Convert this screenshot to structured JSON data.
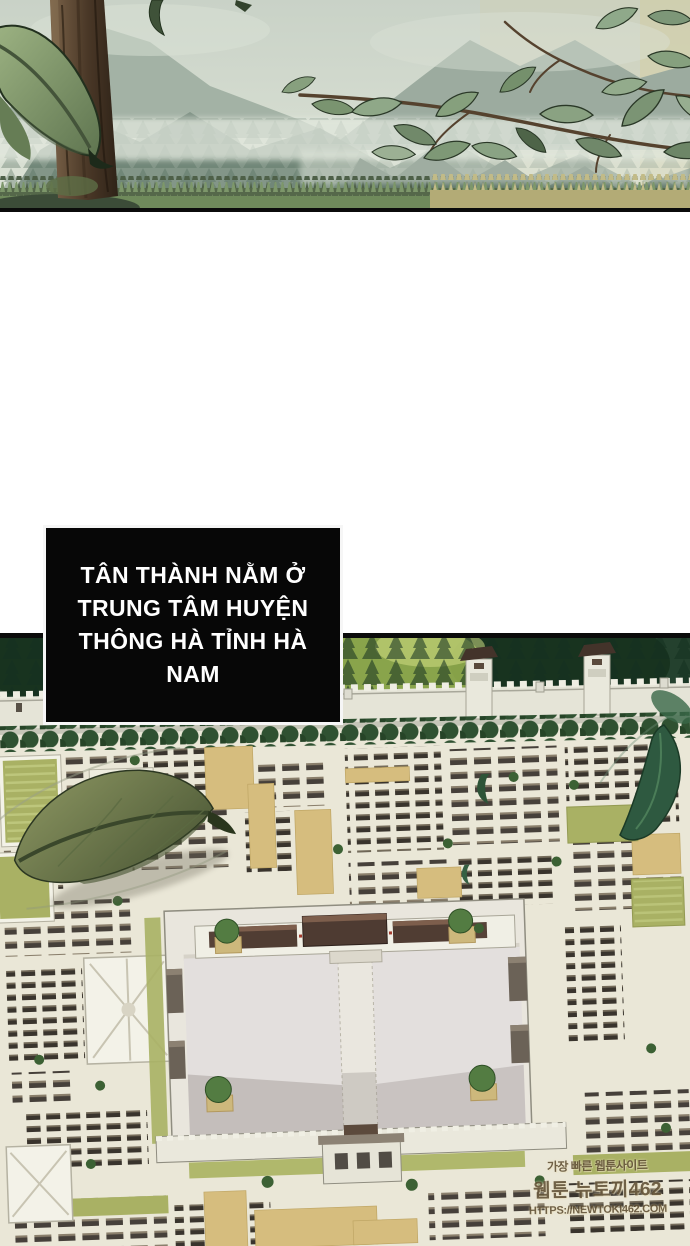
{
  "caption": {
    "lines": [
      "TÂN THÀNH NẰM Ở",
      "TRUNG TÂM HUYỆN",
      "THÔNG HÀ TỈNH HÀ",
      "NAM"
    ]
  },
  "watermark": {
    "line1": "가장 빠른 웹툰사이트",
    "line2": "웹툰 뉴토끼462",
    "line3": "HTTPS://NEWTOKI462.COM"
  },
  "panels": {
    "nature": {
      "alt": "Misty mountain valley with pine forest, tree trunk, grass and falling leaves"
    },
    "city": {
      "alt": "Aerial isometric view of an ancient walled city with a large central palace courtyard"
    }
  },
  "colors": {
    "caption_bg": "#070707",
    "caption_text": "#ffffff",
    "page_bg": "#ffffff",
    "panel_border": "#0b0b0b",
    "city_ground": "#eae7d7",
    "roof_dark": "#46403a",
    "courtyard_tan": "#d6bd7e",
    "garden_olive": "#a9b164",
    "forest_dark": "#24412e",
    "wall_white": "#e5e4d7",
    "plaza_grey": "#e3dfdd",
    "leaf_olive": "#77834f",
    "leaf_dark_green": "#2e5940"
  }
}
